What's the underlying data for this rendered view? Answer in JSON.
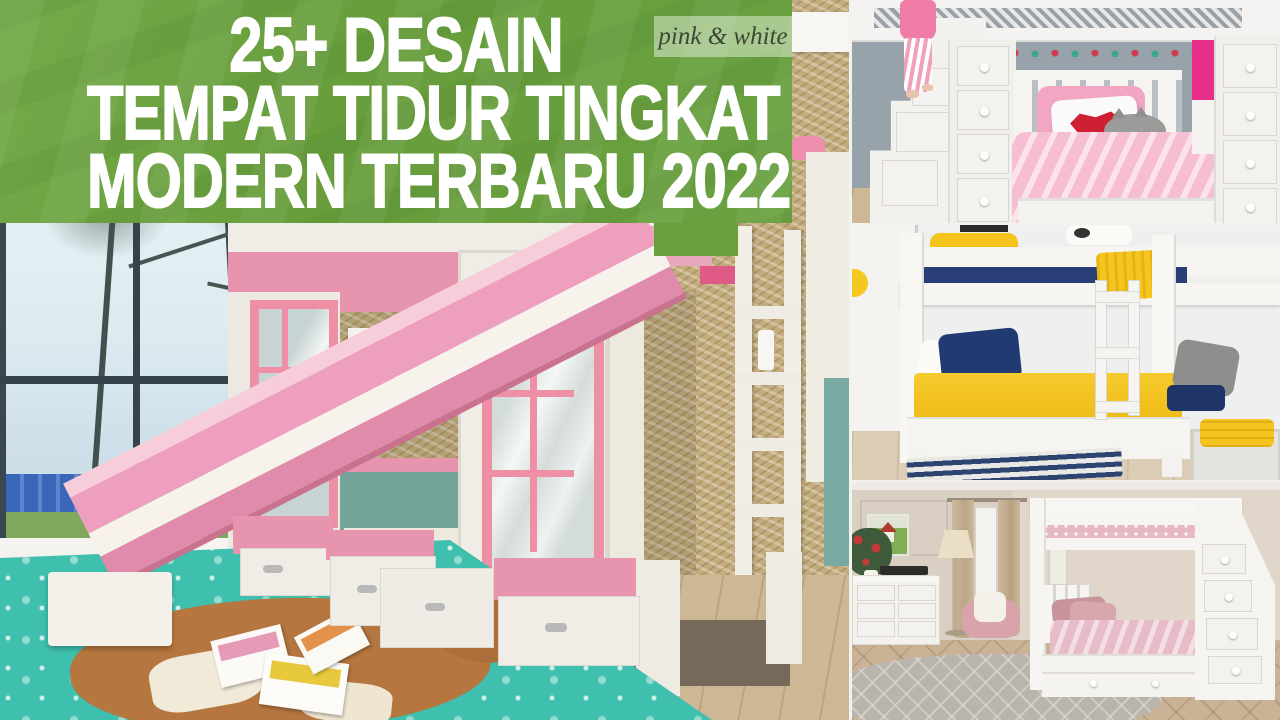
{
  "banner": {
    "title_lines": [
      "25+ DESAIN",
      "TEMPAT TIDUR TINGKAT",
      "MODERN TERBARU 2022"
    ],
    "watermark": "pink & white",
    "bg_color": "#679d3b",
    "text_color": "#ffffff"
  },
  "colors": {
    "accent_pink": "#e794ae",
    "hot_pink": "#e62e8a",
    "teal_rug": "#3fbfae",
    "navy": "#27406f",
    "yellow": "#f2c01d",
    "wall_blue": "#b7d3dc",
    "wall_gray": "#97a2ab",
    "wall_beige": "#d9cfc2"
  },
  "photos": {
    "main": {
      "label": "pink and white playhouse bunk bed with slide, window seat and teal rug"
    },
    "top_right": {
      "label": "white loft bed with storage stairs, drawer towers, pink bedding and red-lips pillow"
    },
    "middle_right": {
      "label": "white bunk bed with navy and yellow bedding and striped rug"
    },
    "bottom_right": {
      "label": "white bunk bed with staircase drawers in beige bedroom with pink bedding"
    }
  }
}
